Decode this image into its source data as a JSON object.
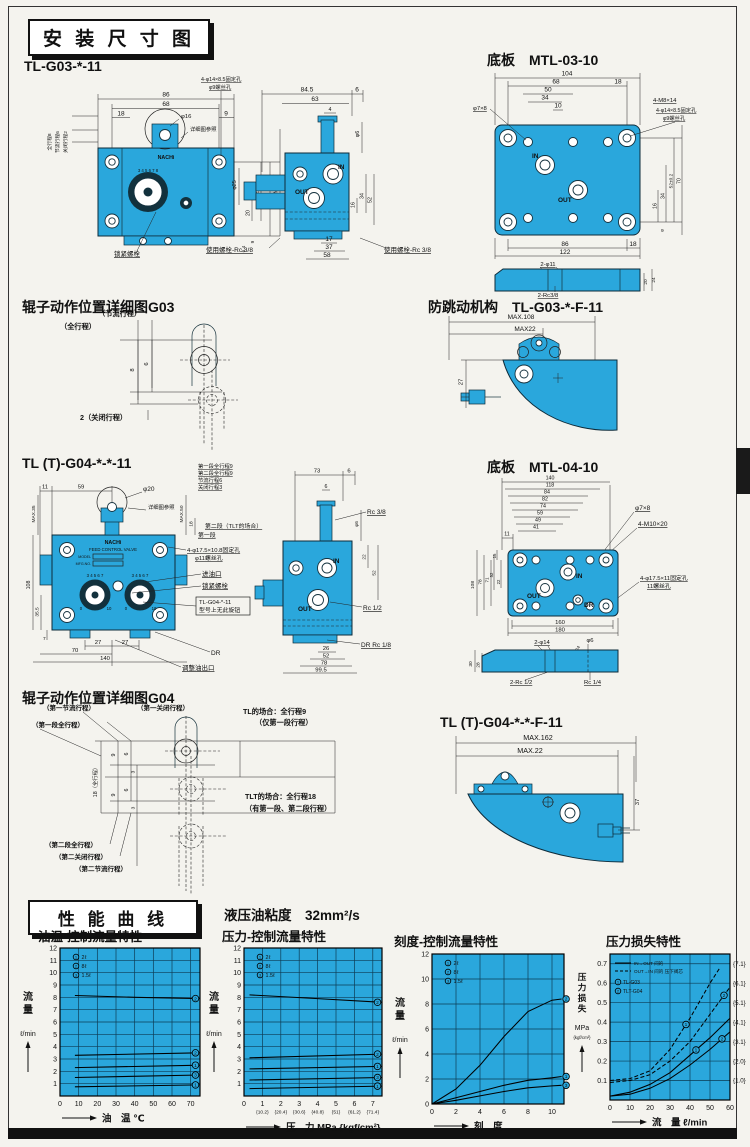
{
  "headers": {
    "dim_title": "安 装 尺 寸 图",
    "perf_title": "性 能 曲 线",
    "viscosity": "液压油粘度　32mm²/s",
    "g03_model": "TL-G03-*-11",
    "plate03": "底板　MTL-03-10",
    "roller03": "辊子动作位置详细图G03",
    "antijump03": "防跳动机构　TL-G03-*-F-11",
    "g04_model": "TL (T)-G04-*-*-11",
    "plate04": "底板　MTL-04-10",
    "roller04": "辊子动作位置详细图G04",
    "antijump04": "TL (T)-G04-*-*-F-11"
  },
  "g03f": {
    "top_dims": [
      "86",
      "68",
      "18",
      "9"
    ],
    "phi16": "φ16",
    "ref": "详细图参照",
    "fix_note": [
      "4-φ14×8.5固定孔",
      "φ9螺丝孔"
    ],
    "stroke_labels": [
      "全行程8",
      "节流行程6",
      "关闭行程2"
    ],
    "right_dims": [
      "52",
      "70",
      "MAX.87",
      "20",
      "9",
      "6.4"
    ],
    "dial_digits": "3 4 5 6 7 8",
    "logo": "NACHi",
    "lock": "锁紧螺栓",
    "bolt": "使用螺栓-Rc 3/8",
    "phi25": "φ25"
  },
  "g03s": {
    "top_dims": [
      "84.5",
      "63",
      "4",
      "6"
    ],
    "phi6": "φ6",
    "in": "IN",
    "out": "OUT",
    "right_dims": [
      "16",
      "34",
      "52"
    ],
    "bot_dims": [
      "17",
      "37",
      "58"
    ],
    "bolt": "使用螺栓-Rc 3/8"
  },
  "p03": {
    "top_dims": [
      "104",
      "68",
      "18",
      "50",
      "34",
      "10"
    ],
    "phi78": "φ7×8",
    "notes": [
      "4-M8×14",
      "4-φ14×8.5固定孔",
      "φ9螺丝孔"
    ],
    "in": "IN",
    "out": "OUT",
    "right_dims": [
      "16",
      "34",
      "52±0.2",
      "70",
      "9"
    ],
    "bot_dims": [
      "86",
      "18",
      "122"
    ],
    "sec": [
      "2-φ11",
      "20",
      "24",
      "2-Rc3/8"
    ]
  },
  "r03": {
    "labels": [
      "（节流行程）",
      "（全行程）",
      "2（关闭行程）"
    ],
    "dims": [
      "8",
      "6"
    ]
  },
  "aj03": {
    "dims": [
      "MAX.108",
      "MAX22",
      "27"
    ]
  },
  "g04f": {
    "strokes": [
      "第一段全行程9",
      "第二段全行程9",
      "节流行程6",
      "关闭行程3"
    ],
    "seg2": "第二段（TLT的场合）",
    "seg1": "第一段",
    "fix_note": [
      "4-φ17.5×10.8固定孔",
      "φ11螺丝孔"
    ],
    "inlet": "进油口",
    "lock": "锁紧螺栓",
    "note": [
      "TL-G04-*-11",
      "型号上无此旋钮"
    ],
    "dr": "DR",
    "adj": "调整油出口",
    "top_dims": [
      "11",
      "59"
    ],
    "phi20": "φ20",
    "ref": "详细图参照",
    "max35": "MAX.35",
    "max50": "MAX.50",
    "d18": "18",
    "left_dims": [
      "108",
      "35.5",
      "7"
    ],
    "bot_dims": [
      "27",
      "27",
      "70",
      "140"
    ],
    "logo": "NACHi",
    "valve": "FEED CONTROL VALVE",
    "model": "MODEL",
    "mfg": "MFG.NO.",
    "dial_digits": "3 4 5 6 7",
    "dial_lo": "0",
    "dial_hi": "10"
  },
  "g04s": {
    "top_dims": [
      "73",
      "6",
      "6"
    ],
    "rc38": "Rc 3/8",
    "phi6": "φ6",
    "right_dims": [
      "22",
      "52"
    ],
    "in": "IN",
    "out": "OUT",
    "rc12": "Rc 1/2",
    "dr": "DR Rc 1/8",
    "bot_dims": [
      "26",
      "52",
      "78",
      "99.5"
    ]
  },
  "p04": {
    "top_dims": [
      "140",
      "118",
      "84",
      "82",
      "74",
      "59",
      "49",
      "41",
      "11"
    ],
    "phi78": "φ7×8",
    "m10": "4-M10×20",
    "fix_note": [
      "4-φ17.5×11固定孔",
      "11螺丝孔"
    ],
    "in": "IN",
    "out": "OUT",
    "dr": "DR",
    "left_dims": [
      "15",
      "52",
      "22"
    ],
    "outer_dims": [
      "108",
      "78",
      "71"
    ],
    "bot_dims": [
      "160",
      "180"
    ],
    "sec": [
      "2-φ14",
      "φ6",
      "24",
      "30",
      "28",
      "2-Rc 1/2",
      "Rc 1/4"
    ]
  },
  "r04": {
    "top_labels": [
      "（第一节流行程）",
      "（第一关闭行程）",
      "（第一段全行程）"
    ],
    "tl": [
      "TL的场合：全行程9",
      "（仅第一段行程）"
    ],
    "tlt": [
      "TLT的场合：全行程18",
      "（有第一段、第二段行程）"
    ],
    "full": "18（全行程）",
    "dims": [
      "9",
      "6",
      "3",
      "9",
      "6",
      "3"
    ],
    "bot_labels": [
      "（第二段全行程）",
      "（第二关闭行程）",
      "（第二节流行程）"
    ]
  },
  "aj04": {
    "dims": [
      "MAX.162",
      "MAX.22",
      "37"
    ]
  },
  "chart_data": [
    {
      "type": "line",
      "title": "油温-控制流量特性",
      "ylabel": "流量",
      "yunit": "ℓ/min",
      "ylim": [
        0,
        12
      ],
      "yticks": [
        1,
        2,
        3,
        4,
        5,
        6,
        7,
        8,
        9,
        10,
        11,
        12
      ],
      "xlabel": "油　温 ℃",
      "xlim": [
        0,
        75
      ],
      "xticks": [
        0,
        10,
        20,
        30,
        40,
        50,
        60,
        70
      ],
      "legend": [
        {
          "marker": "1",
          "label": "2ℓ"
        },
        {
          "marker": "2",
          "label": "8ℓ"
        },
        {
          "marker": "3",
          "label": "1.5ℓ"
        }
      ],
      "series": [
        {
          "marker": "2",
          "points": [
            [
              8,
              8.15
            ],
            [
              40,
              8.0
            ],
            [
              75,
              7.9
            ]
          ]
        },
        {
          "marker": "2",
          "points": [
            [
              8,
              3.3
            ],
            [
              75,
              3.5
            ]
          ]
        },
        {
          "marker": "1",
          "points": [
            [
              8,
              2.3
            ],
            [
              75,
              2.5
            ]
          ]
        },
        {
          "marker": "3",
          "points": [
            [
              8,
              1.5
            ],
            [
              75,
              1.7
            ]
          ]
        },
        {
          "marker": "1",
          "points": [
            [
              8,
              0.75
            ],
            [
              75,
              0.9
            ]
          ]
        }
      ]
    },
    {
      "type": "line",
      "title": "压力-控制流量特性",
      "ylabel": "流量",
      "yunit": "ℓ/min",
      "ylim": [
        0,
        12
      ],
      "yticks": [
        1,
        2,
        3,
        4,
        5,
        6,
        7,
        8,
        9,
        10,
        11,
        12
      ],
      "xlabel": "压　力 MPa {kgf/cm²}",
      "xlim": [
        0,
        7.5
      ],
      "xticks": [
        0,
        1,
        2,
        3,
        4,
        5,
        6,
        7
      ],
      "xticks_sub": [
        "",
        "{10.2}",
        "{20.4}",
        "{30.6}",
        "{40.8}",
        "{51}",
        "{61.2}",
        "{71.4}"
      ],
      "legend": [
        {
          "marker": "1",
          "label": "2ℓ"
        },
        {
          "marker": "2",
          "label": "8ℓ"
        },
        {
          "marker": "3",
          "label": "1.5ℓ"
        }
      ],
      "series": [
        {
          "marker": "2",
          "points": [
            [
              0.3,
              8.2
            ],
            [
              4,
              7.9
            ],
            [
              7.5,
              7.6
            ]
          ]
        },
        {
          "marker": "2",
          "points": [
            [
              0.3,
              3.1
            ],
            [
              7.5,
              3.4
            ]
          ]
        },
        {
          "marker": "1",
          "points": [
            [
              0.3,
              2.2
            ],
            [
              7.5,
              2.4
            ]
          ]
        },
        {
          "marker": "3",
          "points": [
            [
              0.3,
              1.3
            ],
            [
              7.5,
              1.5
            ]
          ]
        },
        {
          "marker": "1",
          "points": [
            [
              0.3,
              0.6
            ],
            [
              7.5,
              0.8
            ]
          ]
        }
      ]
    },
    {
      "type": "line",
      "title": "刻度-控制流量特性",
      "ylabel": "流量",
      "yunit": "ℓ/min",
      "ylim": [
        0,
        12
      ],
      "yticks": [
        0,
        2,
        4,
        6,
        8,
        10,
        12
      ],
      "xlabel": "刻　度",
      "xlim": [
        0,
        11
      ],
      "xticks": [
        0,
        2,
        4,
        6,
        8,
        10
      ],
      "legend": [
        {
          "marker": "1",
          "label": "2ℓ"
        },
        {
          "marker": "2",
          "label": "8ℓ"
        },
        {
          "marker": "3",
          "label": "1.5ℓ"
        }
      ],
      "series": [
        {
          "marker": "2",
          "points": [
            [
              0,
              0
            ],
            [
              2,
              1.2
            ],
            [
              4,
              3.1
            ],
            [
              6,
              5.4
            ],
            [
              8,
              7.4
            ],
            [
              10,
              8.3
            ],
            [
              10.8,
              8.4
            ]
          ]
        },
        {
          "marker": "1",
          "points": [
            [
              0,
              0
            ],
            [
              2,
              0.5
            ],
            [
              4,
              1.0
            ],
            [
              6,
              1.5
            ],
            [
              8,
              1.9
            ],
            [
              10,
              2.1
            ],
            [
              10.8,
              2.2
            ]
          ]
        },
        {
          "marker": "3",
          "points": [
            [
              0,
              0
            ],
            [
              2,
              0.3
            ],
            [
              4,
              0.65
            ],
            [
              6,
              1.0
            ],
            [
              8,
              1.3
            ],
            [
              10,
              1.45
            ],
            [
              10.8,
              1.5
            ]
          ]
        }
      ]
    },
    {
      "type": "line",
      "title": "压力损失特性",
      "ylabel": "压力损失",
      "yunit": "MPa",
      "yunit2": "{kgf/cm²}",
      "ylim": [
        0,
        0.75
      ],
      "yticks": [
        0.1,
        0.2,
        0.3,
        0.4,
        0.5,
        0.6,
        0.7
      ],
      "yticks_right": [
        "{1.0}",
        "{2.0}",
        "{3.1}",
        "{4.1}",
        "{5.1}",
        "{6.1}",
        "{7.1}"
      ],
      "xlabel": "流　量 ℓ/min",
      "xlim": [
        0,
        60
      ],
      "xticks": [
        0,
        10,
        20,
        30,
        40,
        50,
        60
      ],
      "legend_lines": [
        {
          "style": "solid",
          "label": "IN→OUT 间的"
        },
        {
          "style": "dashed",
          "label": "OUT→IN 间的 压下阀芯"
        }
      ],
      "legend": [
        {
          "marker": "1",
          "label": "TL-G03"
        },
        {
          "marker": "2",
          "label": "TLT-G04"
        }
      ],
      "series": [
        {
          "style": "dashed",
          "marker": "1",
          "marker_at": 38,
          "points": [
            [
              0,
              0.1
            ],
            [
              10,
              0.11
            ],
            [
              20,
              0.15
            ],
            [
              30,
              0.26
            ],
            [
              40,
              0.42
            ],
            [
              50,
              0.6
            ],
            [
              55,
              0.68
            ]
          ]
        },
        {
          "style": "dashed",
          "marker": "2",
          "marker_at": 57,
          "points": [
            [
              0,
              0.09
            ],
            [
              10,
              0.1
            ],
            [
              20,
              0.13
            ],
            [
              30,
              0.2
            ],
            [
              40,
              0.3
            ],
            [
              50,
              0.44
            ],
            [
              60,
              0.58
            ]
          ]
        },
        {
          "style": "solid",
          "marker": "1",
          "marker_at": 43,
          "points": [
            [
              0,
              0.02
            ],
            [
              10,
              0.04
            ],
            [
              20,
              0.08
            ],
            [
              30,
              0.14
            ],
            [
              40,
              0.23
            ],
            [
              50,
              0.32
            ],
            [
              60,
              0.42
            ]
          ]
        },
        {
          "style": "solid",
          "marker": "2",
          "marker_at": 56,
          "points": [
            [
              0,
              0.02
            ],
            [
              10,
              0.03
            ],
            [
              20,
              0.06
            ],
            [
              30,
              0.11
            ],
            [
              40,
              0.18
            ],
            [
              50,
              0.26
            ],
            [
              60,
              0.35
            ]
          ]
        }
      ]
    }
  ]
}
